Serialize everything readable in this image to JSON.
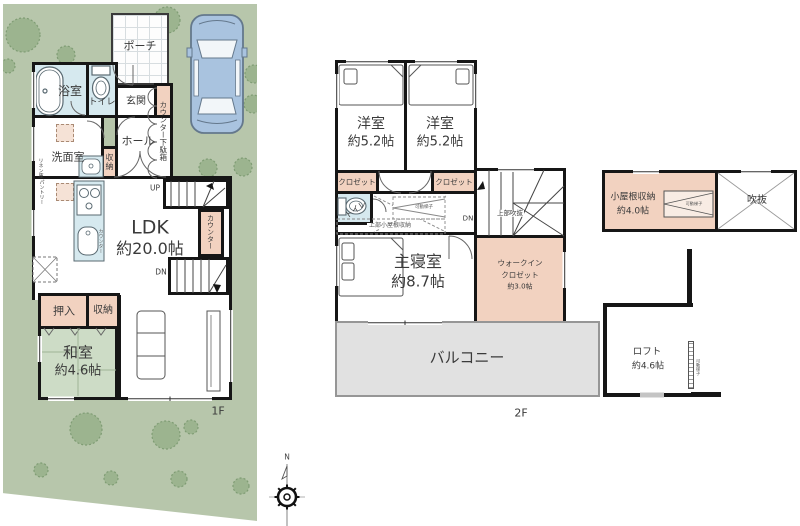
{
  "compass": {
    "north": "N"
  },
  "colors": {
    "site_green": "#b7c6ab",
    "tree_green": "#9cb48f",
    "wall_black": "#161616",
    "wet_blue": "#d6e9ef",
    "storage_orange": "#f2d2c0",
    "tatami_green": "#cddcc6",
    "balcony_gray": "#e1e1e1",
    "car_blue": "#a9c3df"
  },
  "f1": {
    "label": "1F",
    "porch": "ポーチ",
    "bath": "浴室",
    "toilet": "トイレ",
    "entrance": "玄関",
    "shoe_cabinet": "カウンター下駄箱",
    "hall": "ホール",
    "washroom": "洗面室",
    "hall_storage": "収納",
    "linen": "リネン庫",
    "pantry": "パントリー",
    "kitchen_counter": "カウンター",
    "up": "UP",
    "ldk_name": "LDK",
    "ldk_size": "約20.0帖",
    "stair_counter": "カウンター",
    "dn": "DN",
    "oshiire": "押入",
    "storage": "収納",
    "washitsu_name": "和室",
    "washitsu_size": "約4.6帖"
  },
  "f2": {
    "label": "2F",
    "bedroom1_name": "洋室",
    "bedroom1_size": "約5.2帖",
    "bedroom2_name": "洋室",
    "bedroom2_size": "約5.2帖",
    "closet1": "クロゼット",
    "closet2": "クロゼット",
    "toilet": "トイレ",
    "ladder": "可動梯子",
    "attic_above": "上部小屋根収納",
    "void_above": "上部吹抜",
    "dn": "DN",
    "master_name": "主寝室",
    "master_size": "約8.7帖",
    "wic_line1": "ウォークイン",
    "wic_line2": "クロゼット",
    "wic_line3": "約3.0帖",
    "balcony": "バルコニー"
  },
  "af": {
    "storage_name": "小屋根収納",
    "storage_size": "約4.0帖",
    "ladder": "可動梯子",
    "void": "吹抜",
    "loft_name": "ロフト",
    "loft_size": "約4.6帖",
    "loft_ladder": "可動梯子"
  }
}
